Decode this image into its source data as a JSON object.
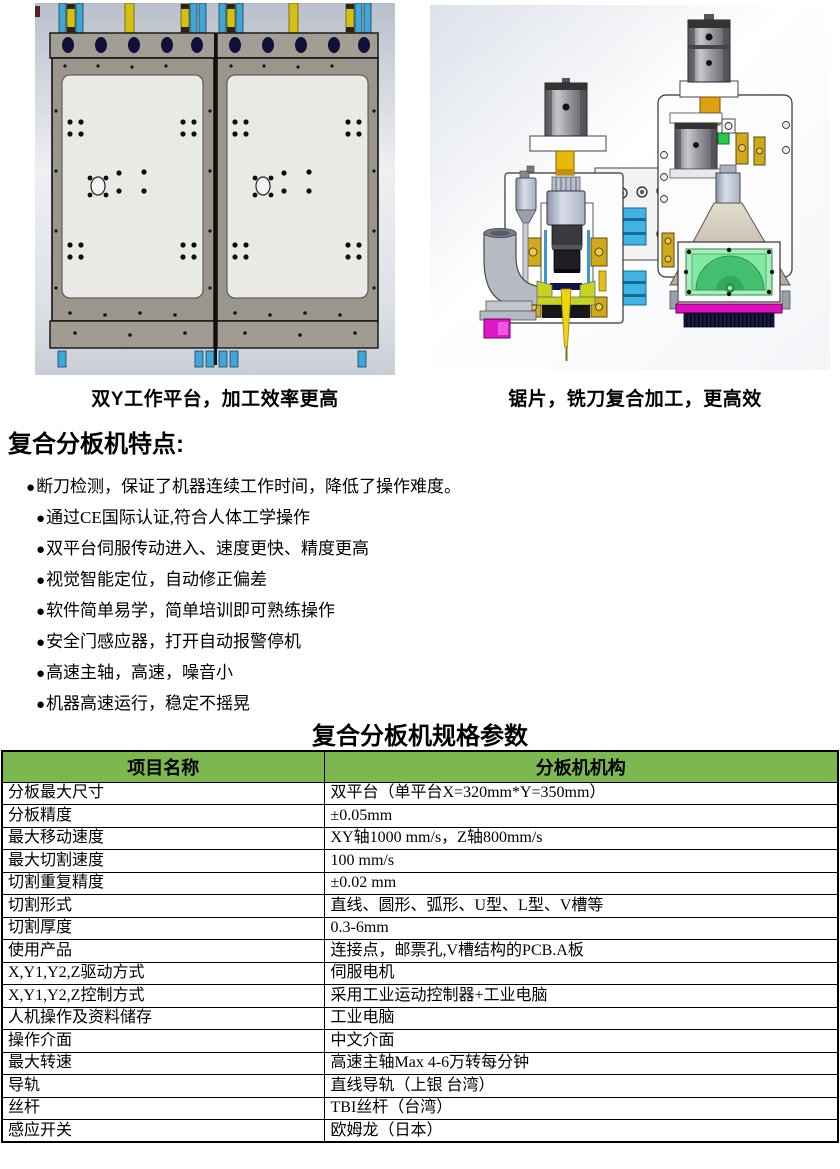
{
  "renders": {
    "left": {
      "caption": "双Y工作平台，加工效率更高"
    },
    "right": {
      "caption": "锯片，铣刀复合加工，更高效"
    }
  },
  "features": {
    "heading": "复合分板机特点:",
    "bullet_char": "●",
    "items": [
      "断刀检测，保证了机器连续工作时间，降低了操作难度。",
      "通过CE国际认证,符合人体工学操作",
      "双平台伺服传动进入、速度更快、精度更高",
      "视觉智能定位，自动修正偏差",
      "软件简单易学，简单培训即可熟练操作",
      "安全门感应器，打开自动报警停机",
      "高速主轴，高速，噪音小",
      "机器高速运行，稳定不摇晃"
    ]
  },
  "specs": {
    "title": "复合分板机规格参数",
    "header_bg": "#7CB84F",
    "header": {
      "col1": "项目名称",
      "col2": "分板机机构"
    },
    "rows": [
      {
        "name": "分板最大尺寸",
        "value": "双平台（单平台X=320mm*Y=350mm）"
      },
      {
        "name": "分板精度",
        "value": "±0.05mm"
      },
      {
        "name": "最大移动速度",
        "value": "XY轴1000 mm/s，Z轴800mm/s"
      },
      {
        "name": "最大切割速度",
        "value": "100 mm/s"
      },
      {
        "name": "切割重复精度",
        "value": "±0.02 mm"
      },
      {
        "name": "切割形式",
        "value": "直线、圆形、弧形、U型、L型、V槽等"
      },
      {
        "name": "切割厚度",
        "value": "0.3-6mm"
      },
      {
        "name": "使用产品",
        "value": "连接点，邮票孔,V槽结构的PCB.A板"
      },
      {
        "name": "X,Y1,Y2,Z驱动方式",
        "value": "伺服电机"
      },
      {
        "name": "X,Y1,Y2,Z控制方式",
        "value": "采用工业运动控制器+工业电脑"
      },
      {
        "name": "人机操作及资料储存",
        "value": "工业电脑"
      },
      {
        "name": "操作介面",
        "value": "中文介面"
      },
      {
        "name": "最大转速",
        "value": "高速主轴Max 4-6万转每分钟"
      },
      {
        "name": "导轨",
        "value": "直线导轨（上银 台湾）"
      },
      {
        "name": "丝杆",
        "value": "TBI丝杆（台湾）"
      },
      {
        "name": "感应开关",
        "value": "欧姆龙（日本）"
      }
    ]
  },
  "colors": {
    "table_header_green": "#7CB84F",
    "render_rail_cyan": "#40B4E4",
    "render_slider_yellow": "#D4C010",
    "render_magenta": "#E010C0",
    "render_saw_window_green": "#84E8A2",
    "render_navy": "#101448",
    "render_tool_yellow": "#F0D410"
  }
}
